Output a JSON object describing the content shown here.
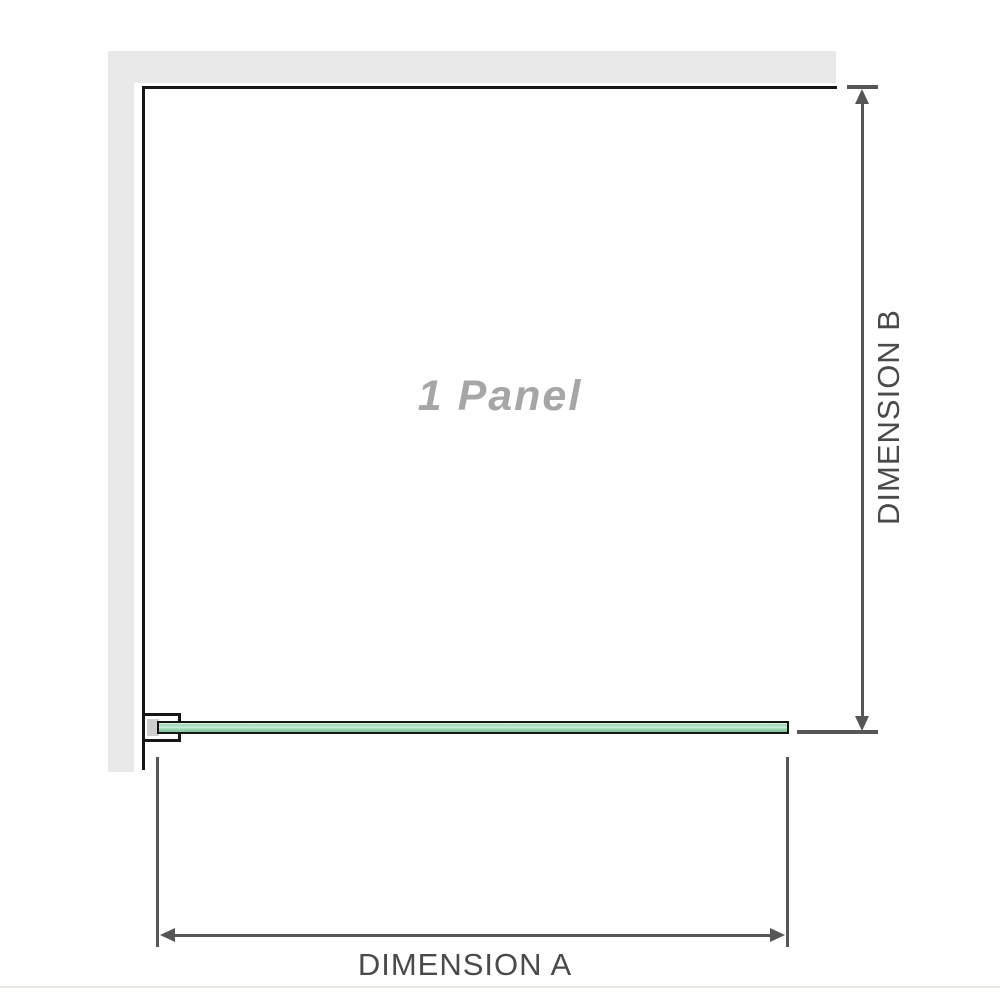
{
  "diagram": {
    "panel_label": "1 Panel",
    "dimension_a_label": "DIMENSION A",
    "dimension_b_label": "DIMENSION B"
  },
  "colors": {
    "wall": "#e9e9e9",
    "outline": "#161616",
    "dimension_line": "#565656",
    "dimension_text": "#4a4a4a",
    "panel_text": "#a6a6a6",
    "glass_light": "#cdeedd",
    "glass_mid": "#9ad6b0",
    "glass_dark": "#7fc69a",
    "bracket_pad": "#cfcfcf",
    "footer_line": "#ebe8e3"
  }
}
